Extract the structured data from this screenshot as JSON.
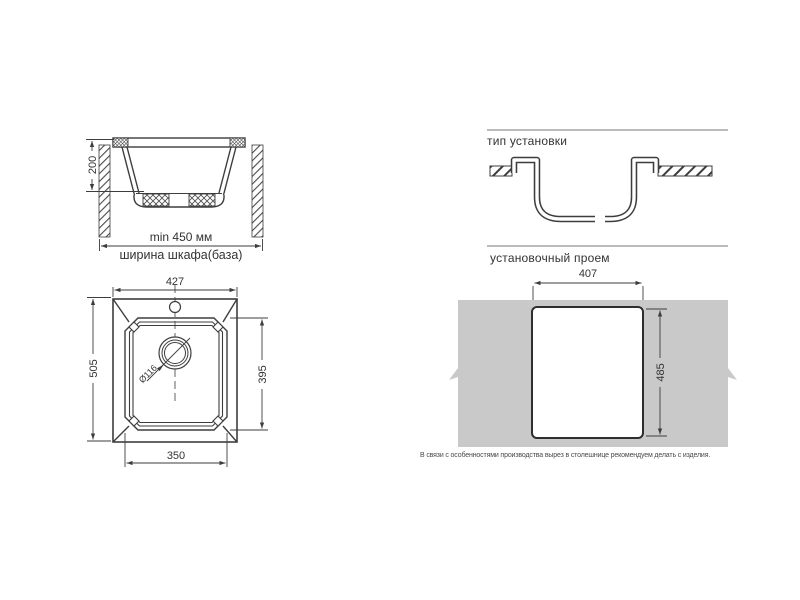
{
  "colors": {
    "line": "#3d3d3d",
    "text": "#333333",
    "countertop_gray": "#c9c9c9"
  },
  "section_view": {
    "depth_dim": "200",
    "min_width_label": "min 450 мм",
    "caption": "ширина шкафа(база)"
  },
  "install_type": {
    "title": "тип установки"
  },
  "top_view": {
    "overall_width": "427",
    "overall_depth": "505",
    "bowl_depth": "395",
    "bowl_width": "350",
    "drain_diameter": "Ø116"
  },
  "cutout_view": {
    "title": "установочный проем",
    "cutout_width": "407",
    "cutout_height": "485",
    "note": "В связи с особенностями производства вырез в столешнице рекомендуем делать с изделия."
  }
}
